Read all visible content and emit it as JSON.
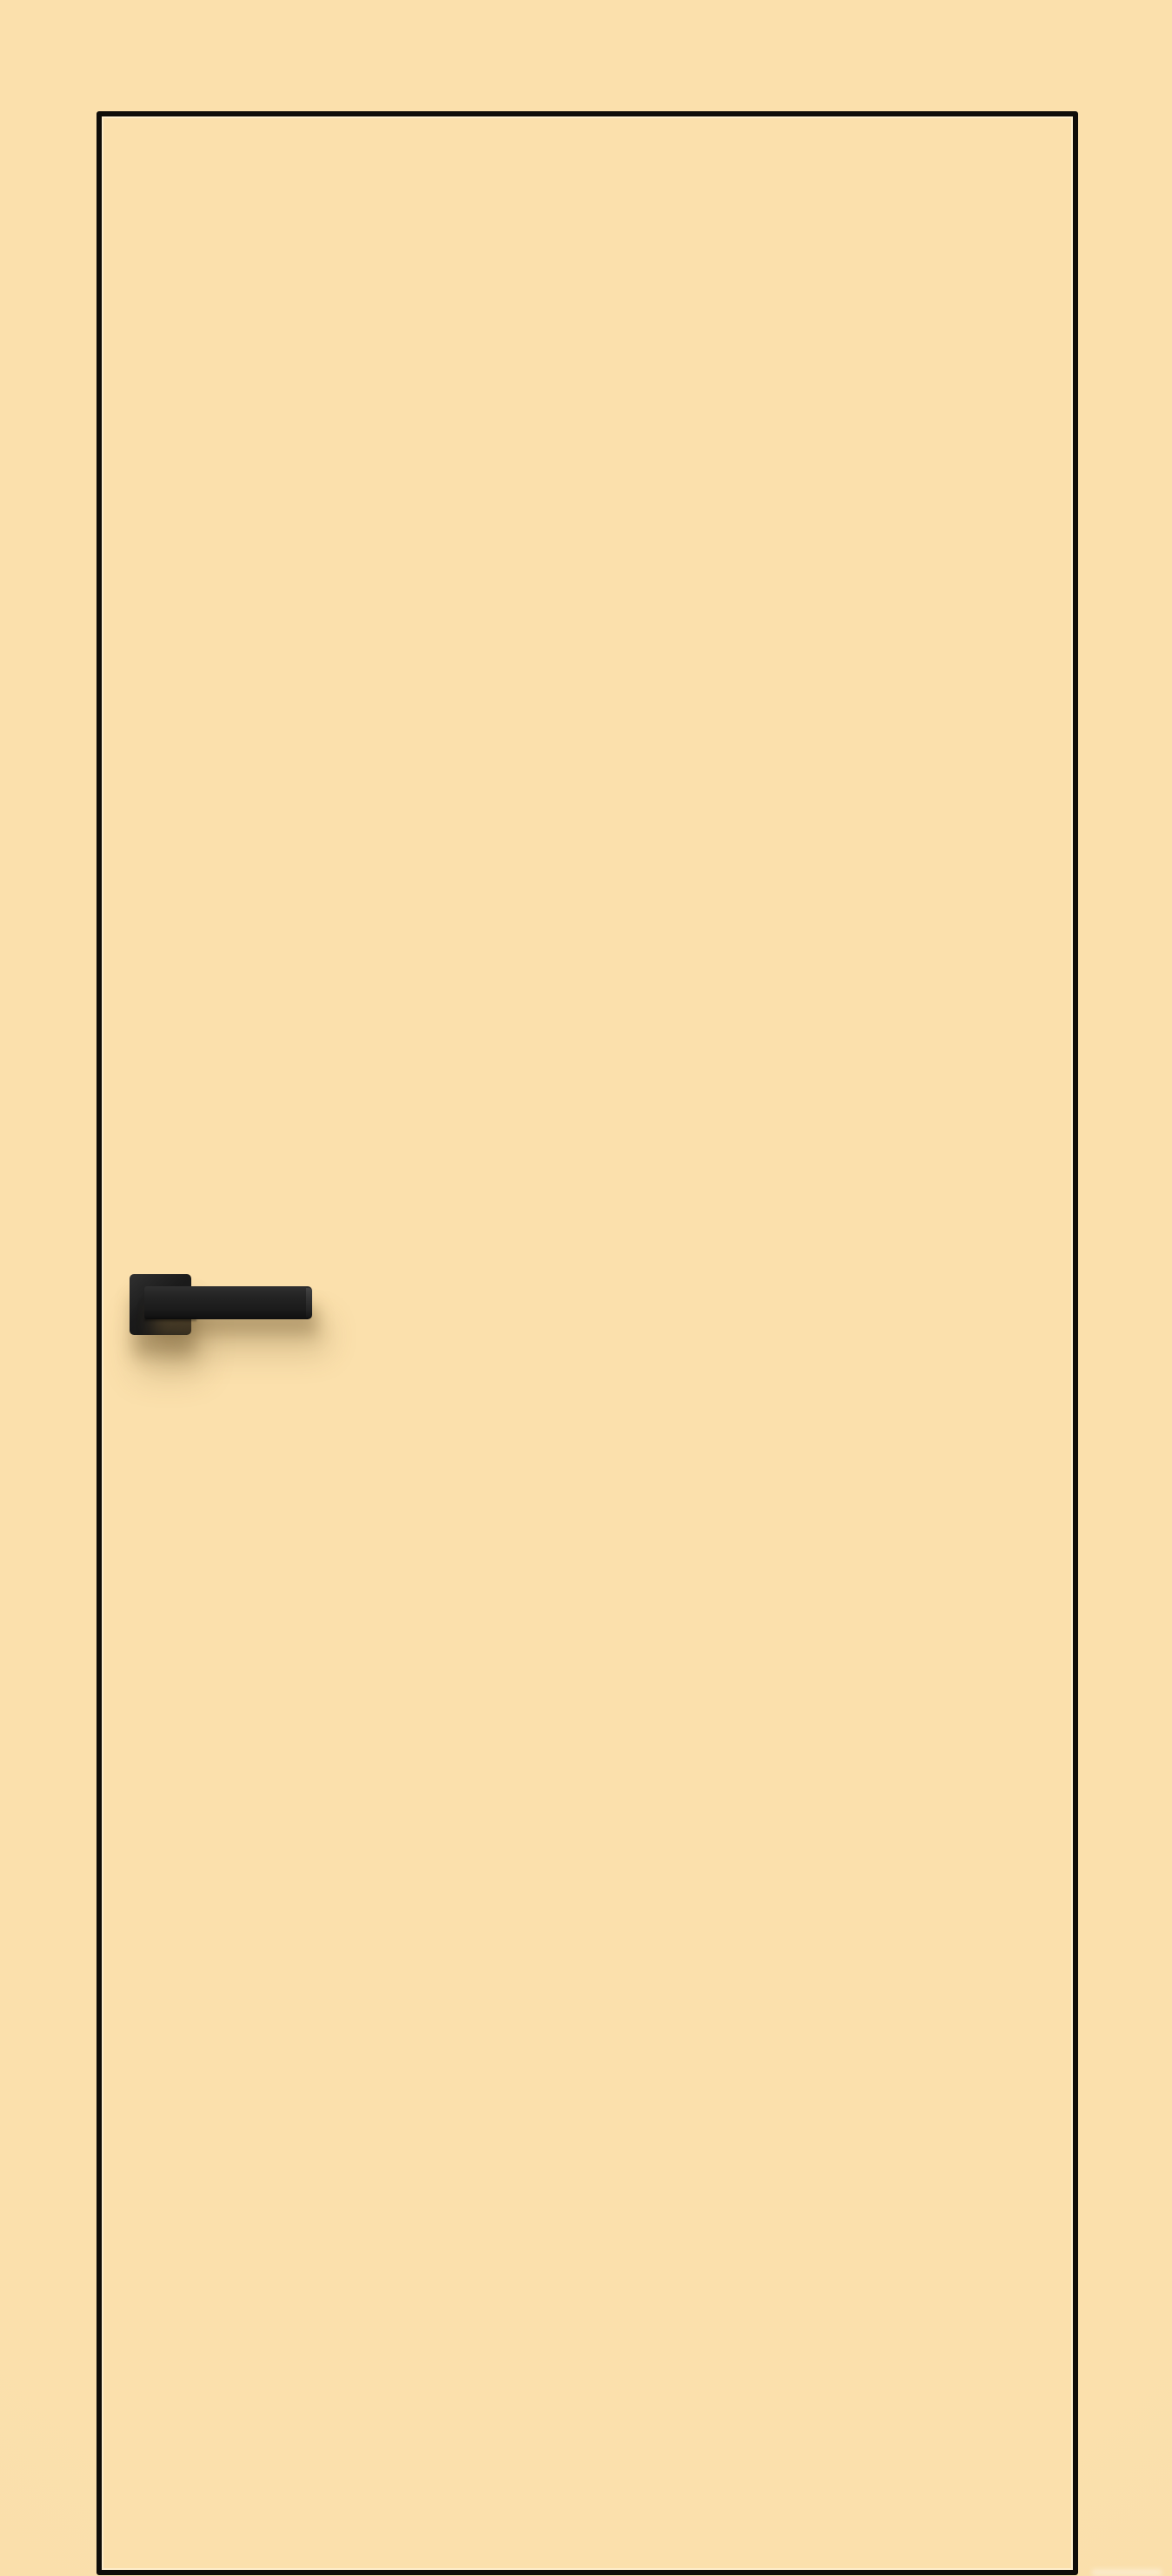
{
  "scene": {
    "type": "product-photo",
    "subject": "Flush interior door leaf in cream finish with thin dark edge outline and matte black square-rosette lever handle on the left side",
    "door": {
      "finish": "flat cream, no panels or glazing",
      "outline": "thin near-black contour around the leaf, bottom edge touching image bottom",
      "handle_side": "left",
      "handle_style": "square rosette with straight bar lever pointing right"
    },
    "colors": {
      "background": "#FBE0AC",
      "door_fill": "#FBE0AC",
      "door_outline": "#0F0D09",
      "handle_black": "#1B1B1B",
      "handle_highlight": "#303030",
      "shadow_warm": "rgba(120,95,55,0.42)"
    }
  }
}
